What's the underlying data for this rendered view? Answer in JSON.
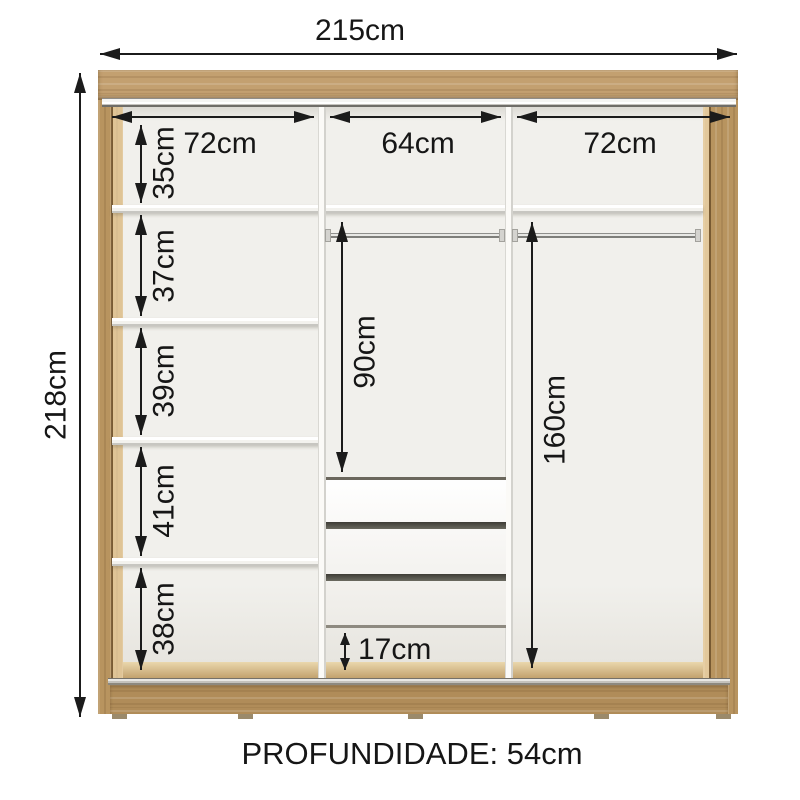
{
  "labels": {
    "width_total": "215cm",
    "height_total": "218cm",
    "depth": "PROFUNDIDADE: 54cm",
    "sections": [
      "72cm",
      "64cm",
      "72cm"
    ],
    "left_gaps": [
      "35cm",
      "37cm",
      "39cm",
      "41cm",
      "38cm"
    ],
    "hang_mid": "90cm",
    "hang_right": "160cm",
    "bottom_gap": "17cm"
  },
  "colors": {
    "wood": "#bf9c6b",
    "wood_dark": "#b08c59",
    "interior": "#f1f0ec",
    "shelf_white": "#fbfaf7",
    "metal_rail": "#c6c4bf",
    "drawer_gap": "#5e5c52",
    "dimension_line": "#1b1b1b",
    "background": "#ffffff"
  }
}
